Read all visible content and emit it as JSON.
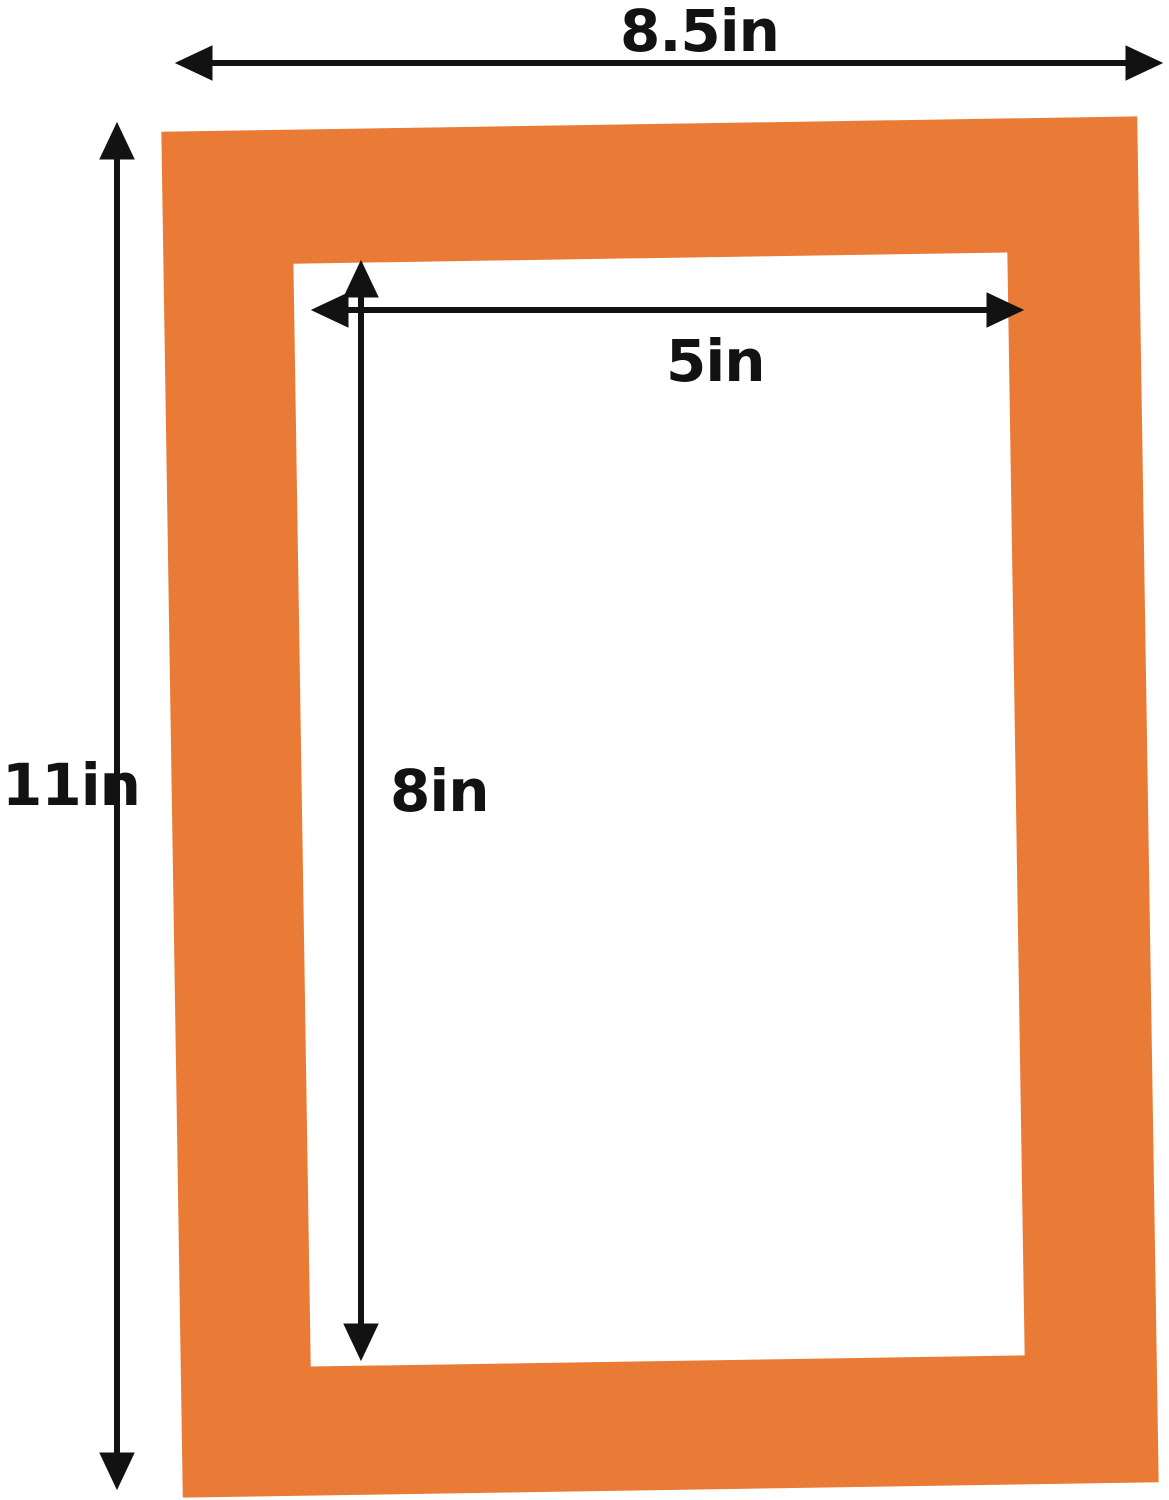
{
  "diagram": {
    "title": "Mat board with opening - dimension diagram",
    "frame_color": "#EA7B36",
    "arrow_color": "#121212",
    "background_color": "#ffffff",
    "dimensions": {
      "outer_width": {
        "label": "8.5in",
        "value": 8.5,
        "unit": "in",
        "measures": "outer width of orange mat"
      },
      "outer_height": {
        "label": "11in",
        "value": 11,
        "unit": "in",
        "measures": "outer height of orange mat"
      },
      "inner_width": {
        "label": "5in",
        "value": 5,
        "unit": "in",
        "measures": "width of white opening"
      },
      "inner_height": {
        "label": "8in",
        "value": 8,
        "unit": "in",
        "measures": "height of white opening"
      }
    }
  }
}
